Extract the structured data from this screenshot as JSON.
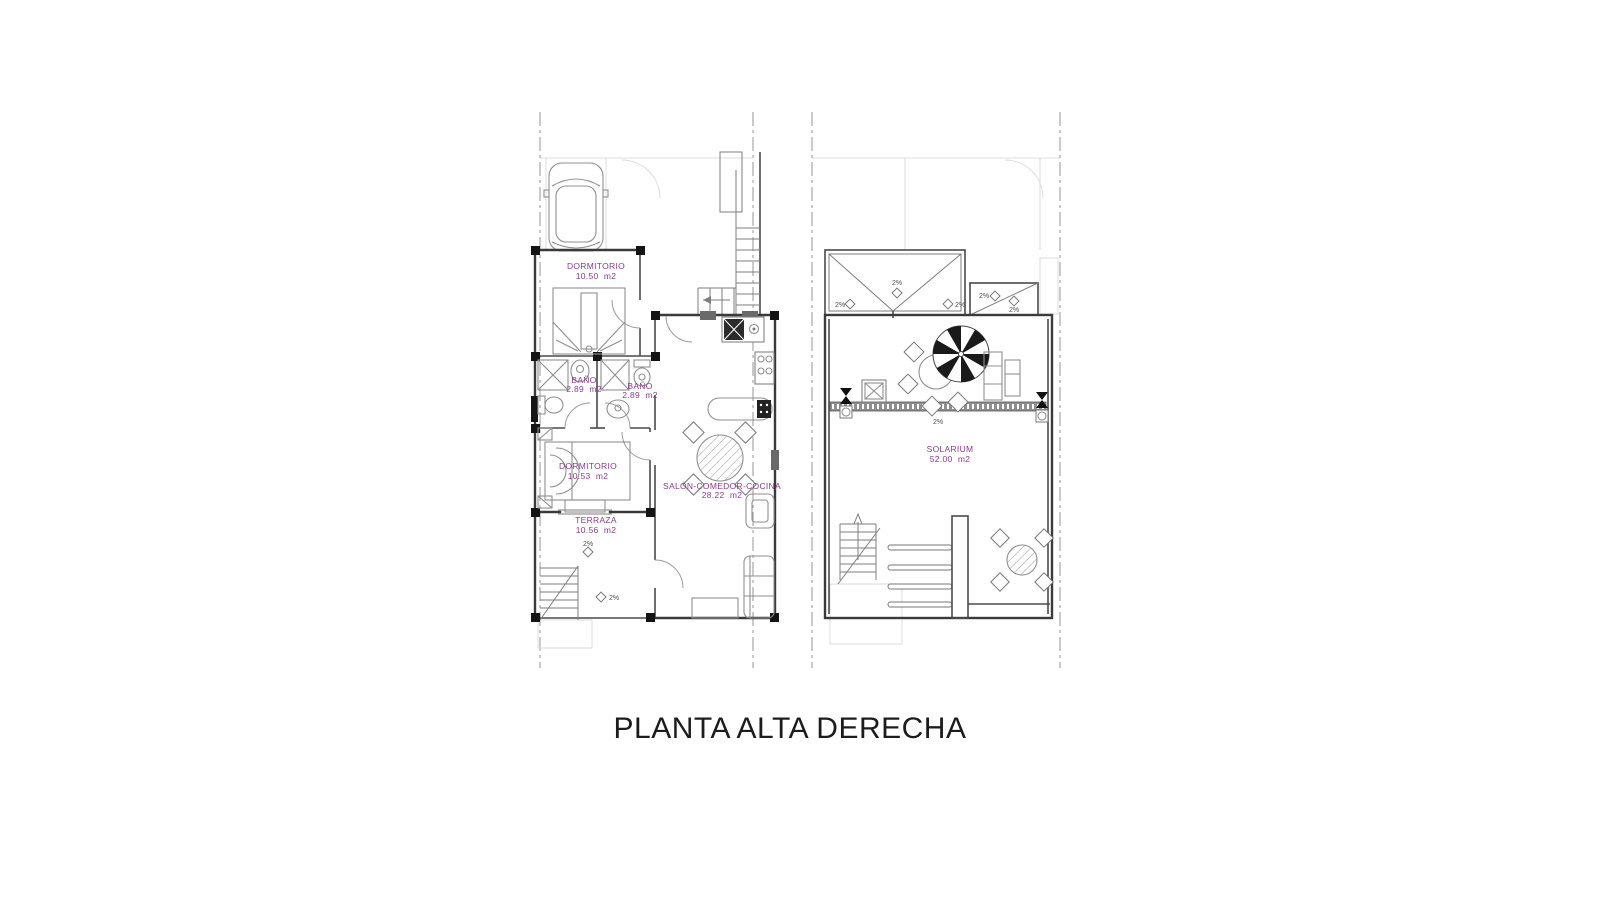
{
  "title": "PLANTA ALTA DERECHA",
  "colors": {
    "label_purple": "#8e3a8e",
    "wall_gray": "#3a3a3a",
    "title_black": "#1c1c1c",
    "background": "#ffffff"
  },
  "floor_plan": {
    "rooms": [
      {
        "id": "dormitorio-1",
        "name": "DORMITORIO",
        "area": "10.50  m2"
      },
      {
        "id": "bano-1",
        "name": "BAÑO",
        "area": "2.89  m2"
      },
      {
        "id": "bano-2",
        "name": "BAÑO",
        "area": "2.89  m2"
      },
      {
        "id": "dormitorio-2",
        "name": "DORMITORIO",
        "area": "10.53  m2"
      },
      {
        "id": "terraza",
        "name": "TERRAZA",
        "area": "10.56  m2"
      },
      {
        "id": "salon",
        "name": "SALÓN-COMEDOR-COCINA",
        "area": "28.22  m2"
      }
    ]
  },
  "roof_plan": {
    "rooms": [
      {
        "id": "solarium",
        "name": "SOLARIUM",
        "area": "52.00  m2"
      }
    ]
  },
  "annotations": {
    "slope": "2%"
  }
}
